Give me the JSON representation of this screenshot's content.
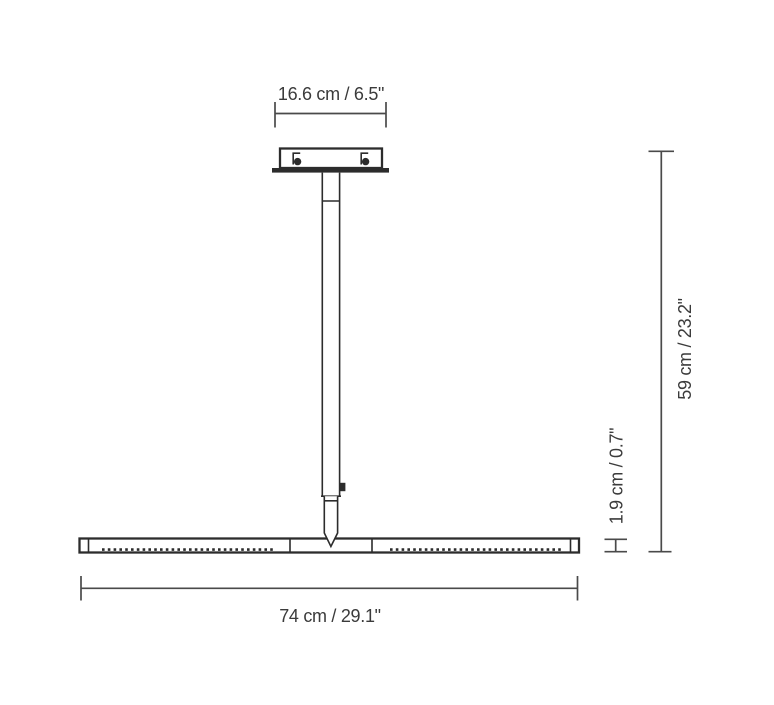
{
  "diagram": {
    "kind": "technical-dimension-drawing",
    "subject": "linear-pendant-lamp-front-view"
  },
  "dimensions": {
    "canopy_width": {
      "label": "16.6 cm / 6.5\"",
      "value_cm": 16.6,
      "value_in": 6.5,
      "orientation": "horizontal",
      "position": "top"
    },
    "total_height": {
      "label": "59 cm / 23.2\"",
      "value_cm": 59,
      "value_in": 23.2,
      "orientation": "vertical",
      "position": "right-outer"
    },
    "bar_height": {
      "label": "1.9 cm / 0.7\"",
      "value_cm": 1.9,
      "value_in": 0.7,
      "orientation": "vertical",
      "position": "right-inner"
    },
    "total_width": {
      "label": "74 cm / 29.1\"",
      "value_cm": 74,
      "value_in": 29.1,
      "orientation": "horizontal",
      "position": "bottom"
    }
  },
  "colors": {
    "background": "#ffffff",
    "dimension_line": "#4a4a4a",
    "drawing_line": "#2c2c2c",
    "text": "#3b3b3b"
  }
}
